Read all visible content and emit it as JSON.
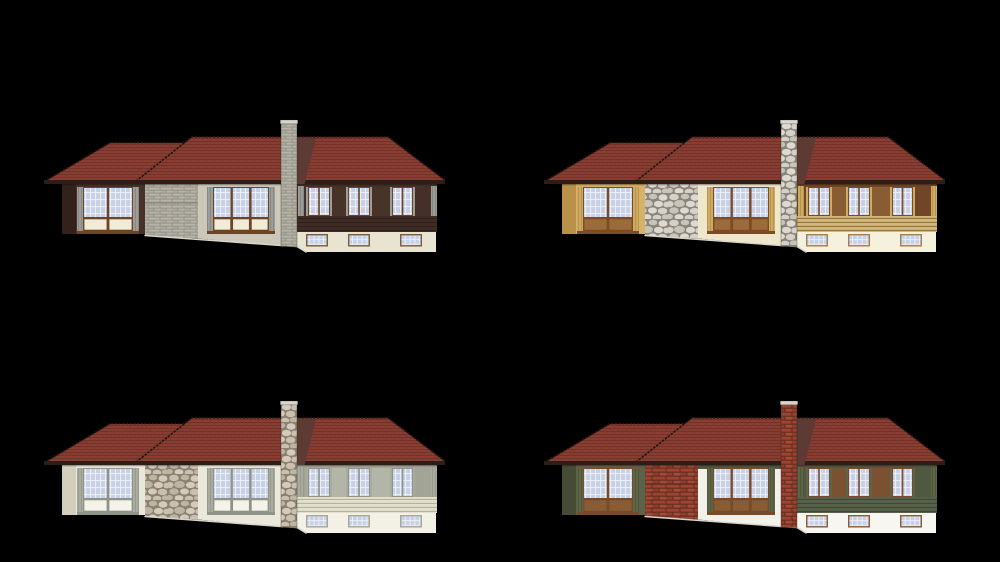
{
  "canvas": {
    "width": 1000,
    "height": 562,
    "background": "#000000"
  },
  "grid": {
    "rows": 2,
    "cols": 2
  },
  "shared": {
    "roof": "#8a3d31",
    "roof_line": "#6a2e25",
    "fascia": "#2b1d17",
    "roof_edge": "#201510",
    "roof_shadow": "#5d3a34",
    "glass": "#c7d0e5",
    "glass_grid": "#eef1f8",
    "ground_edge": "#d9d6cb"
  },
  "houses": [
    {
      "cell": "top-left",
      "variant": "dark-walnut-gray-block",
      "origin": {
        "x": 40,
        "y": 115
      },
      "palette": {
        "wall": "#473028",
        "wall_shadow": "#33221c",
        "trim": "#9c9c98",
        "trim_line": "#74746d",
        "frame": "#6b4526",
        "spandrel": "#f1ebd8",
        "mid_wall": "#cbc8b9",
        "mid_top": "#cbc8b9",
        "wing_wall": "#443028",
        "panel": "#483329",
        "band": "#3f2c25",
        "band_line": "#2a1c17",
        "basement": "#e9e3d1",
        "basement_frame": "#7a5a38",
        "masonry_type": "block",
        "masonry_mortar": "#8e8b80",
        "masonry_a": "#b7b4a9",
        "masonry_b": "#adaa9e",
        "masonry_c": "#b1ae9f",
        "cap": "#d8d5ca"
      }
    },
    {
      "cell": "top-right",
      "variant": "golden-tan-fieldstone",
      "origin": {
        "x": 540,
        "y": 115
      },
      "palette": {
        "wall": "#d7b168",
        "wall_shadow": "#ba9148",
        "trim": "#cdab61",
        "trim_line": "#a07f3c",
        "frame": "#7b4b27",
        "spandrel": "#9c6b3b",
        "mid_wall": "#efe7cc",
        "mid_top": "#efe7cc",
        "wing_wall": "#6f4626",
        "panel": "#8a5c33",
        "band": "#d2b778",
        "band_line": "#8a693c",
        "basement": "#f6f1dd",
        "basement_frame": "#a87e44",
        "masonry_type": "stone",
        "masonry_mortar": "#8b867b",
        "masonry_a": "#d5d1c8",
        "masonry_b": "#c8c4b9",
        "masonry_c": "#dedad2",
        "cap": "#dcd9ce"
      }
    },
    {
      "cell": "bottom-left",
      "variant": "cream-fieldstone",
      "origin": {
        "x": 40,
        "y": 396
      },
      "palette": {
        "wall": "#e9e7d9",
        "wall_shadow": "#d2cfbf",
        "trim": "#a8ab9d",
        "trim_line": "#878a7c",
        "frame": "#8f948b",
        "spandrel": "#f5f3e8",
        "mid_wall": "#eae8da",
        "mid_top": "#eae8da",
        "wing_wall": "#a2a496",
        "panel": "#b3b5a7",
        "band": "#e2dfcd",
        "band_line": "#adaa99",
        "basement": "#f3f1e6",
        "basement_frame": "#a5a796",
        "masonry_type": "stone",
        "masonry_mortar": "#8d8171",
        "masonry_a": "#cac0af",
        "masonry_b": "#beb4a2",
        "masonry_c": "#d4cbbc",
        "cap": "#d9d5c8"
      }
    },
    {
      "cell": "bottom-right",
      "variant": "olive-green-red-brick",
      "origin": {
        "x": 540,
        "y": 396
      },
      "palette": {
        "wall": "#5c6247",
        "wall_shadow": "#454b35",
        "trim": "#5d6548",
        "trim_line": "#414830",
        "frame": "#7a4a28",
        "spandrel": "#8a5c34",
        "mid_wall": "#f2f1ea",
        "mid_top": "#4f5840",
        "wing_wall": "#4f5840",
        "panel": "#7b5231",
        "band": "#57604a",
        "band_line": "#3c442e",
        "basement": "#f7f6f0",
        "basement_frame": "#8a5c34",
        "masonry_type": "brick",
        "masonry_mortar": "#632b20",
        "masonry_a": "#9a4634",
        "masonry_b": "#8d3e2d",
        "masonry_c": "#a34b37",
        "cap": "#d8d5ca"
      }
    }
  ]
}
